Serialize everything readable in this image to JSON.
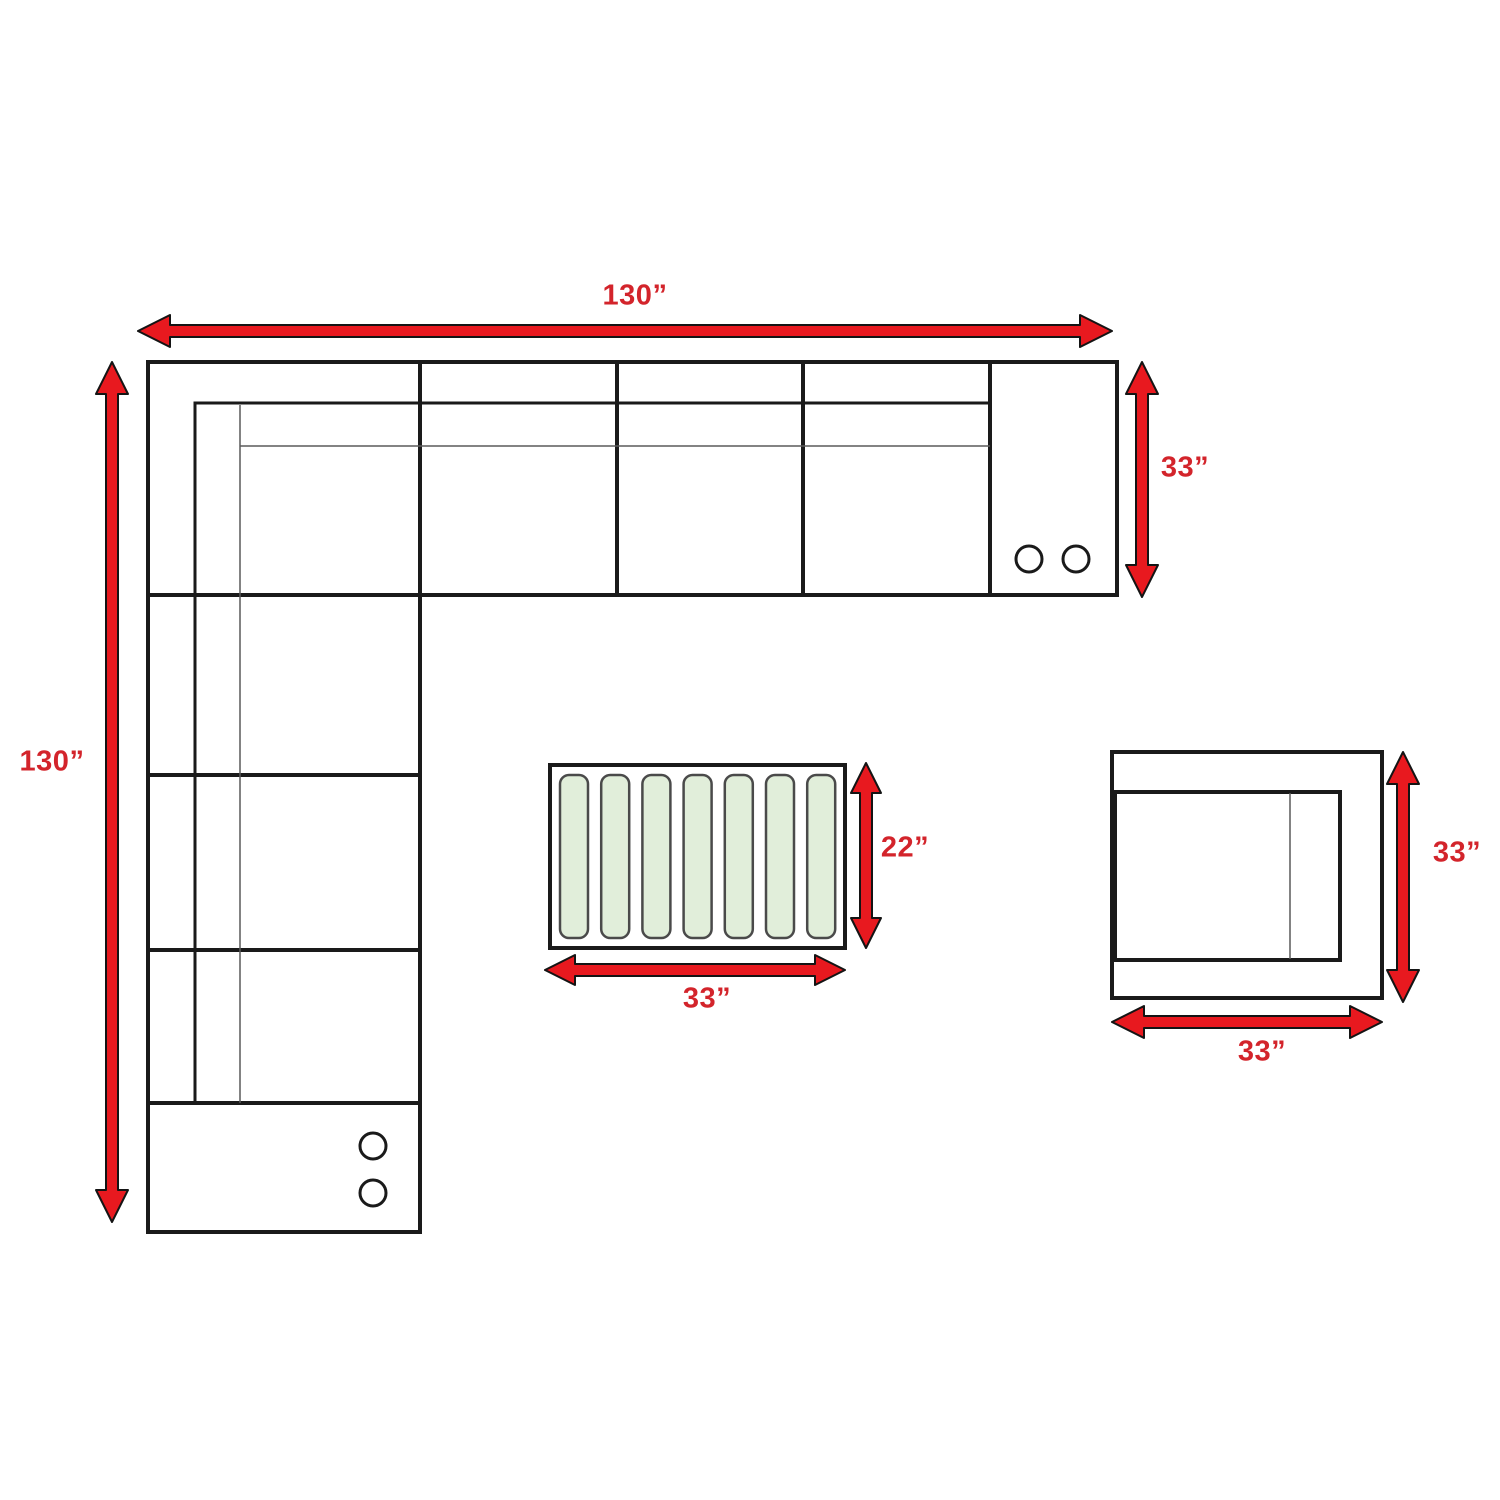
{
  "labels": {
    "sofa_width": "130”",
    "sofa_depth": "130”",
    "sofa_height": "33”",
    "ottoman_depth": "22”",
    "ottoman_width": "33”",
    "chair_depth": "33”",
    "chair_width": "33”"
  },
  "ottoman": {
    "slat_count": 7
  },
  "cupholders": {
    "top_console_count": 2,
    "bottom_console_count": 2
  },
  "colors": {
    "arrow_red": "#e8191f",
    "label_red": "#d3242b",
    "line_black": "#1a1a1a",
    "slat_fill": "#e1eeda",
    "slat_stroke": "#4a4a4a",
    "background": "#ffffff"
  }
}
